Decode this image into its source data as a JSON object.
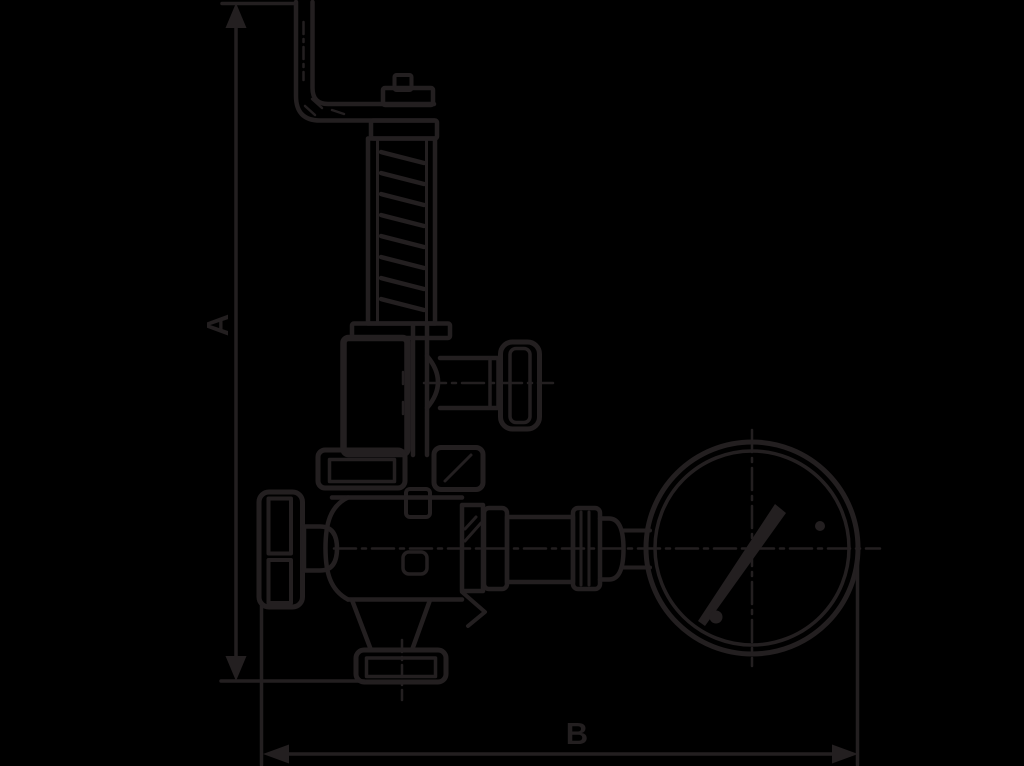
{
  "diagram": {
    "type": "technical-line-drawing",
    "subject": "safety-relief-valve-with-pressure-gauge",
    "background_color": "#000000",
    "line_color": "#231f20",
    "dimensions": {
      "vertical": {
        "label": "A"
      },
      "horizontal": {
        "label": "B"
      }
    },
    "parts": [
      "lift-lever",
      "adjusting-cap",
      "spring-housing",
      "bonnet",
      "test-valve-knob",
      "handwheel",
      "valve-body",
      "mounting-flange",
      "bottom-outlet-flange",
      "gauge-connection",
      "pressure-gauge",
      "gauge-needle"
    ]
  }
}
